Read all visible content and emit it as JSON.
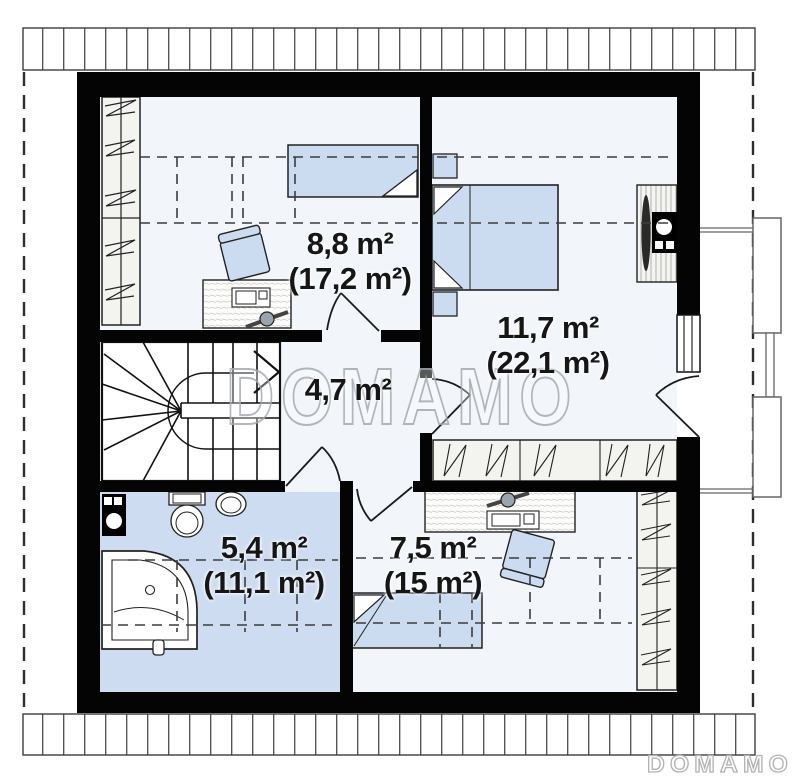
{
  "watermark": {
    "center": "DOMAMO",
    "corner": "DOMAMO"
  },
  "rooms": [
    {
      "name": "bedroom-upper-left",
      "area": "8,8 m²",
      "area_total": "(17,2 m²)"
    },
    {
      "name": "bedroom-right",
      "area": "11,7 m²",
      "area_total": "(22,1 m²)"
    },
    {
      "name": "hall-staircase",
      "area": "4,7 m²",
      "area_total": ""
    },
    {
      "name": "bathroom",
      "area": "5,4 m²",
      "area_total": "(11,1 m²)"
    },
    {
      "name": "bedroom-lower-right",
      "area": "7,5 m²",
      "area_total": "(15 m²)"
    }
  ],
  "colors": {
    "wall": "#000000",
    "furniture_fill": "#ccdcf0",
    "bathroom_floor": "#cddcf0",
    "floor_tint": "#f2f6fa",
    "wardrobe_fill": "#f3f3f0",
    "watermark_outline": "#a5aab2"
  }
}
